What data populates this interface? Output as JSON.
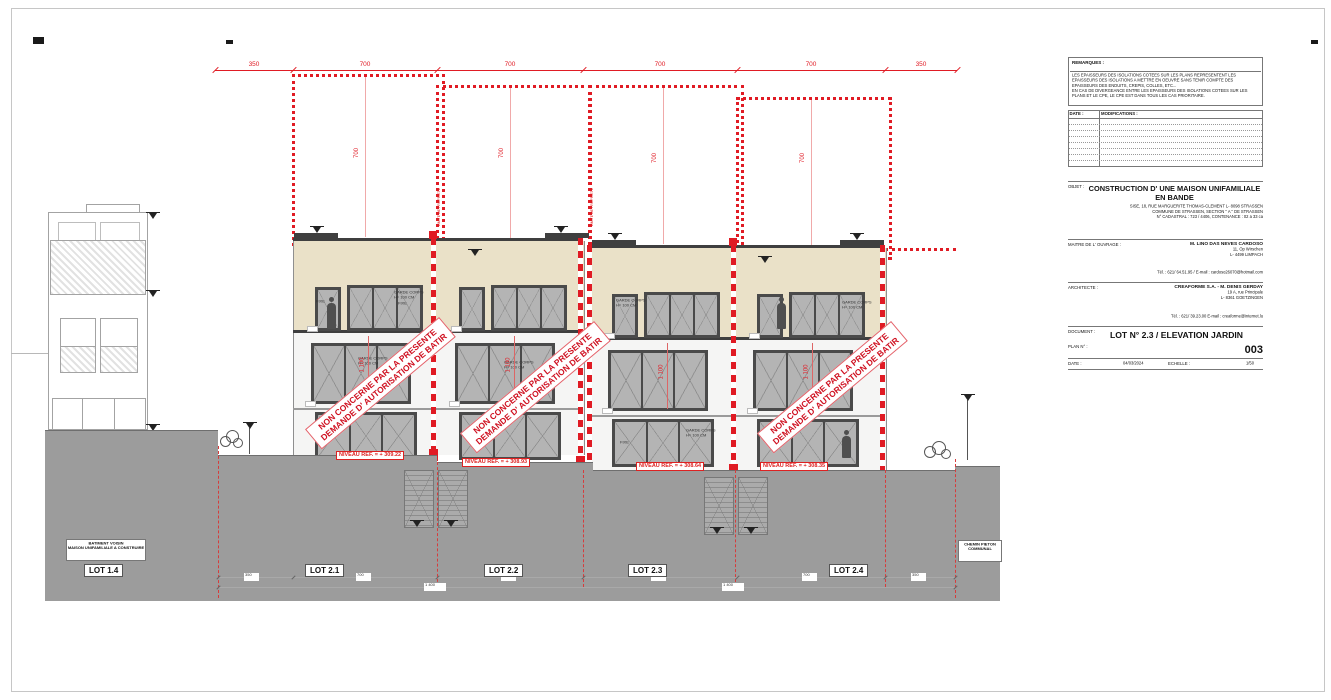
{
  "colors": {
    "red": "#e01b24",
    "stamp_red": "#cf1020",
    "beige": "#eae1c8",
    "terrain_gray": "#9c9c9c",
    "frame_dark": "#4a4a4a"
  },
  "dimensions": {
    "top": [
      "350",
      "700",
      "700",
      "700",
      "700",
      "350"
    ],
    "lot_heights": [
      "700",
      "700",
      "700",
      "700"
    ],
    "storey": "1 100",
    "bottom_row1": [
      "350",
      "700",
      "700",
      "700",
      "700",
      "350"
    ],
    "bottom_row2": [
      "1 400",
      "1 400"
    ]
  },
  "annotations": {
    "stamp_line1": "NON CONCERNE PAR LA PRESENTE",
    "stamp_line2": "DEMANDE D' AUTORISATION DE BATIR",
    "garde_corps": "GARDE CORPS\nH= 100 CM",
    "fixe": "FIXE",
    "boundary_note": "LIMITE DE PROPRIETE",
    "niveau_tags": [
      "NIVEAU REF. = + 309.22",
      "NIVEAU REF. = + 308.93",
      "NIVEAU REF. = + 308.64",
      "NIVEAU REF. = + 308.35"
    ]
  },
  "lots": {
    "lot_14": "LOT 1.4",
    "lot_21": "LOT 2.1",
    "lot_22": "LOT 2.2",
    "lot_23": "LOT 2.3",
    "lot_24": "LOT 2.4",
    "batiment_voisin": "BATIMENT VOISIN\nMAISON UNIFAMILIALE A CONSTRUIRE",
    "chemin_pieton": "CHEMIN PIETON\nCOMMUNAL"
  },
  "title_block": {
    "remarks": {
      "label": "REMARQUES :",
      "text": "LES EPAISSEURS DES ISOLATIONS COTEES SUR LES PLANS REPRESENTENT LES EPAISSEURS DES ISOLATIONS A METTRE EN OEUVRE SANS TENIR COMPTE DES EPAISSEURS DES ENDUITS, CREPIS, COLLES, ETC...\nEN CAS DE DIVERGEANCE ENTRE LES EPAISSEURS DES ISOLATIONS COTEES SUR LES PLANS ET LE CPE, LE CPE EST DANS TOUS LES CAS PRIORITAIRE."
    },
    "table": {
      "date_label": "DATE :",
      "modifications_label": "MODIFICATIONS :"
    },
    "objet": {
      "label": "OBJET :",
      "title": "CONSTRUCTION D' UNE MAISON UNIFAMILIALE EN BANDE",
      "address_lines": "SISE, 18, RUE MARGUERITE THOMAS-CLEMENT L- 8098 STRASSEN\nCOMMUNE DE STRASSEN, SECTION \" A \" DE STRASSEN\nN° CADASTRAL : 723 / 4406, CONTENANCE : 02 a 33 ca"
    },
    "maitre": {
      "label": "MAITRE DE L' OUVRAGE :",
      "name": "M. LINO DAS NEVES CARDOSO",
      "lines": "11, Op Wirschen\nL- 4499 LIMPACH",
      "tel": "Tél. : 621/ 64.51.95 / E-mail : cardoso26070@hotmail.com"
    },
    "architecte": {
      "label": "ARCHITECTE :",
      "name": "CREAFORME S.A. - M. DENIS GERDAY",
      "lines": "19 A, rue Principale\nL- 8361 GOETZINGEN",
      "tel": "Tél. : 621/ 39.23.00  E-mail : creaforme@internet.lu"
    },
    "document": {
      "label": "DOCUMENT :",
      "title": "LOT N° 2.3  /  ELEVATION JARDIN"
    },
    "plan": {
      "label": "PLAN N° :",
      "number": "003"
    },
    "date": {
      "label": "DATE :",
      "value": "04/03/2024"
    },
    "echelle": {
      "label": "ECHELLE :",
      "value": "1/50"
    }
  }
}
